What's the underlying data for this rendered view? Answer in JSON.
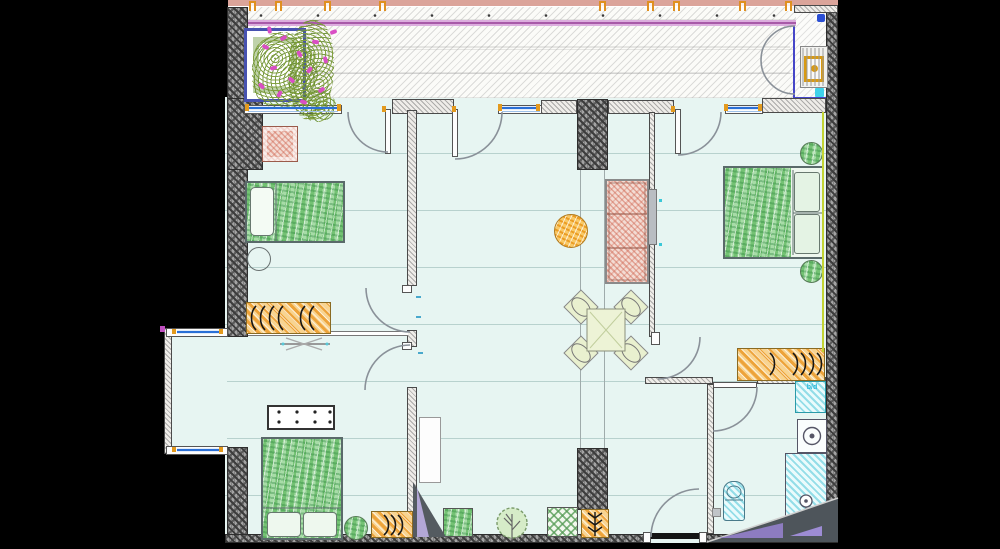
{
  "scene": {
    "kind": "architectural-floor-plan",
    "background": "#000000",
    "drawing_style": "CAD plan with hatched walls and sketch-style furniture"
  },
  "labels": {
    "washer_dryer": "b/d"
  },
  "palette": {
    "floor_cyan": "#e7f5f2",
    "wall_dark_hatch": "#a3a3a3",
    "wall_light_hatch": "#efede9",
    "window_blue": "#2a6fd6",
    "accent_orange": "#e39a1e",
    "railing_magenta": "#b05cb0",
    "facade_pink": "#dba49a",
    "furniture_green": "#8fd08f",
    "wardrobe_orange": "#f0b45a",
    "sofa_red": "#dd8878",
    "fixture_cyan": "#3ec0d4",
    "insulation_yellow": "#c3d433",
    "flower_pink": "#d94fc4",
    "planter_frame_blue": "#4752b0",
    "wedge_gray": "#4e555b",
    "wedge_purple": "#8d7cc0"
  },
  "rooms": [
    "balcony",
    "utility-closet",
    "bedroom-1",
    "bedroom-2-lower",
    "living-dining-room",
    "bedroom-3-right",
    "entry-hall",
    "bathroom",
    "bay-window"
  ],
  "furniture": [
    "armchair",
    "single-bed",
    "double-bed-lower",
    "double-bed-right",
    "wardrobe-with-hangers",
    "hanger-cabinet",
    "hanger-wardrobe-right",
    "sofa",
    "tv-panel",
    "round-pouf",
    "dining-table-with-four-chairs",
    "round-stools",
    "dotted-console-table",
    "planter-with-flowers",
    "floor-plant-panels",
    "tree",
    "ceiling-fan-symbol"
  ],
  "fixtures": [
    "ac-unit",
    "washing-machine",
    "shower",
    "toilet",
    "sink-counter",
    "entrance-door",
    "interior-doors",
    "balcony-doors",
    "windows"
  ]
}
